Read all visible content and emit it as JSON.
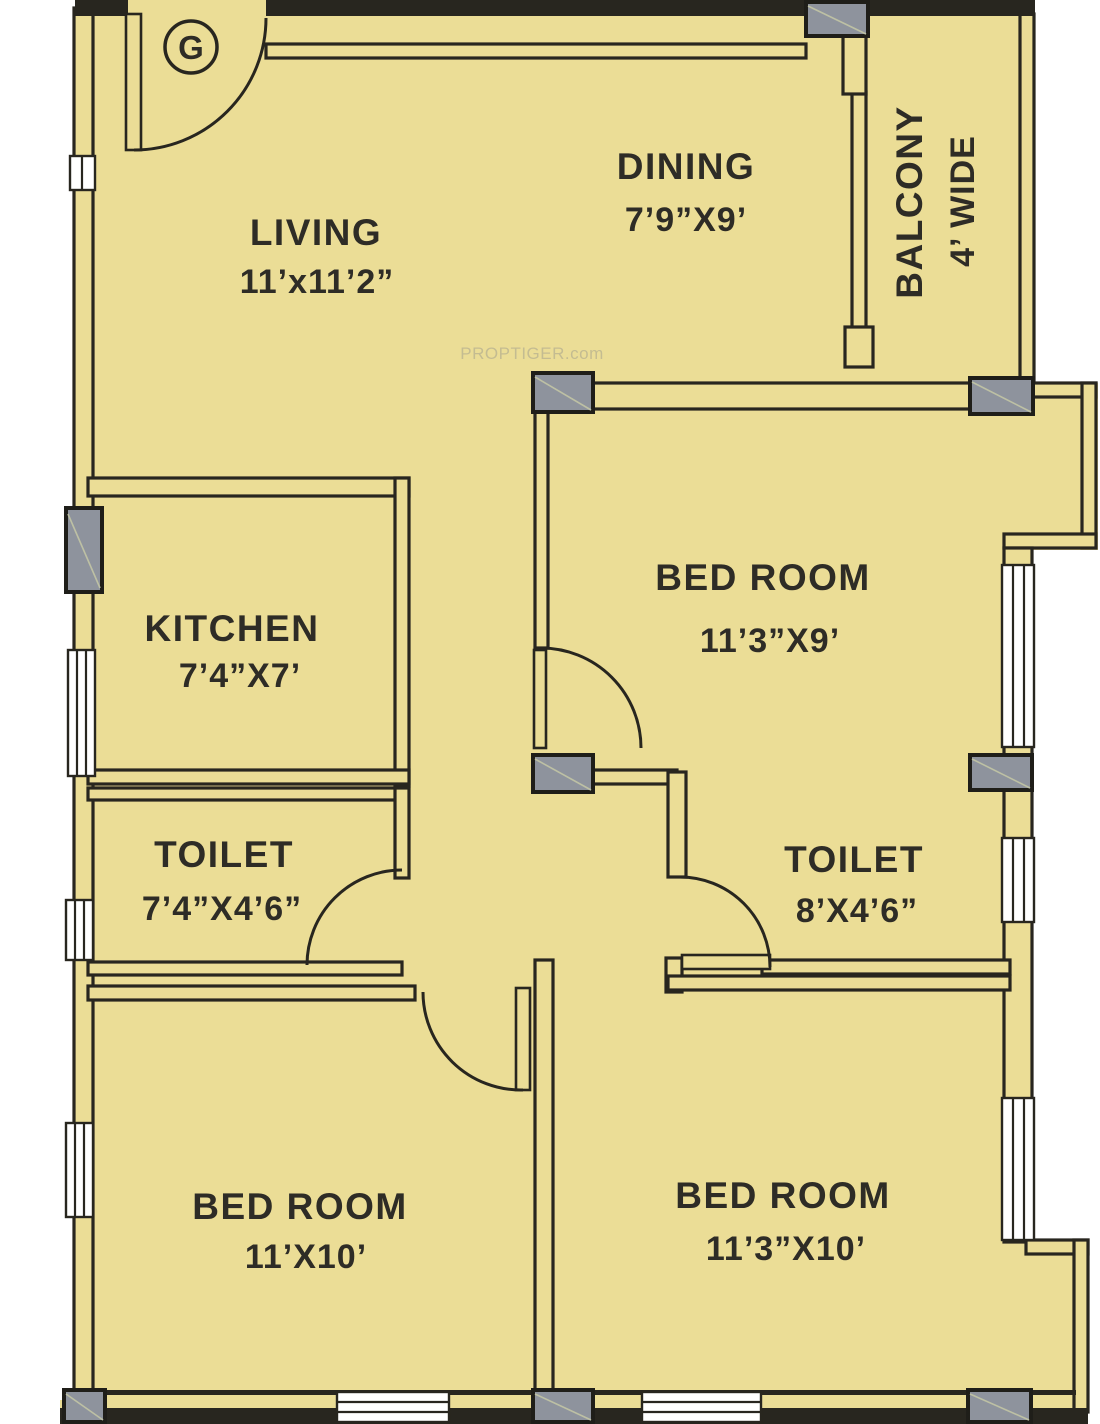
{
  "plan": {
    "title": "3BHK apartment floor plan",
    "entrance_marker": "G",
    "watermark": "PROPTIGER.com",
    "rooms": [
      {
        "id": "living",
        "name": "LIVING",
        "dims": "11’x11’2”"
      },
      {
        "id": "dining",
        "name": "DINING",
        "dims": "7’9”X9’"
      },
      {
        "id": "balcony",
        "name": "BALCONY",
        "dims": "4’ WIDE"
      },
      {
        "id": "kitchen",
        "name": "KITCHEN",
        "dims": "7’4”X7’"
      },
      {
        "id": "bedroom-top-right",
        "name": "BED ROOM",
        "dims": "11’3”X9’"
      },
      {
        "id": "toilet-left",
        "name": "TOILET",
        "dims": "7’4”X4’6”"
      },
      {
        "id": "toilet-right",
        "name": "TOILET",
        "dims": "8’X4’6”"
      },
      {
        "id": "bedroom-bottom-left",
        "name": "BED ROOM",
        "dims": "11’X10’"
      },
      {
        "id": "bedroom-bottom-right",
        "name": "BED ROOM",
        "dims": "11’3”X10’"
      }
    ],
    "colors": {
      "floor": "#ebdd96",
      "wall": "#28261f",
      "column": "#8e939d",
      "text": "#2e2c26",
      "background": "#ffffff"
    }
  }
}
